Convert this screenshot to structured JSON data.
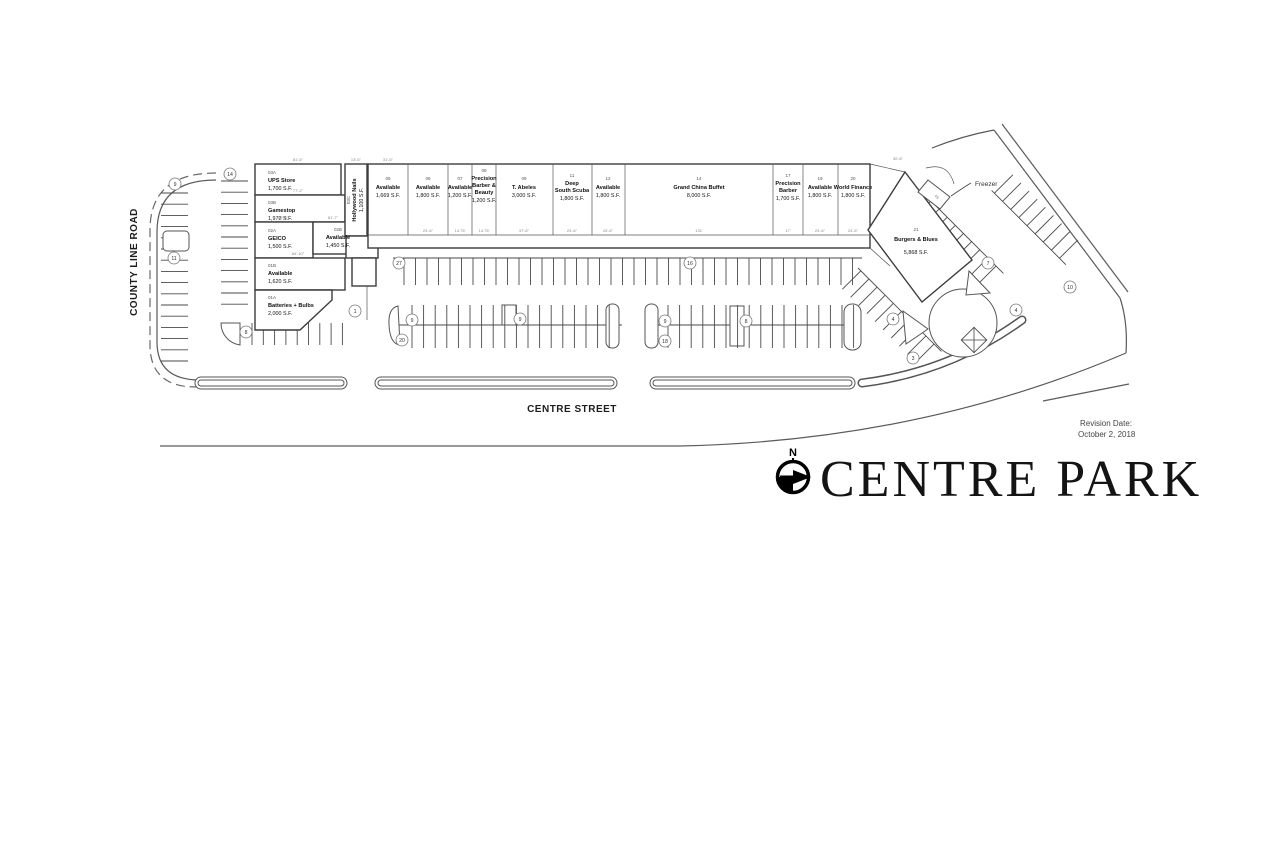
{
  "plan": {
    "title": "CENTRE PARK",
    "north": "N",
    "revision_label": "Revision Date:",
    "revision_date": "October 2, 2018",
    "street_west": "COUNTY LINE ROAD",
    "street_south": "CENTRE STREET",
    "freezer": "Freezer"
  },
  "west_building": {
    "units": [
      {
        "num": "03A",
        "name": "UPS Store",
        "sqft": "1,700 S.F."
      },
      {
        "num": "03B",
        "name": "Gamestop",
        "sqft": "1,972 S.F."
      },
      {
        "num": "02A",
        "name": "GEICO",
        "sqft": "1,500 S.F."
      },
      {
        "num": "02B",
        "name": "Available",
        "sqft": "1,450 S.F."
      },
      {
        "num": "01B",
        "name": "Available",
        "sqft": "1,620 S.F."
      },
      {
        "num": "01A",
        "name": "Batteries + Bulbs",
        "sqft": "2,000 S.F."
      },
      {
        "num": "03C",
        "name": "Hollywood Nails",
        "sqft": "1,100 S.F."
      }
    ]
  },
  "strip_building": {
    "units": [
      {
        "num": "05",
        "n1": "Available",
        "sqft": "1,669 S.F."
      },
      {
        "num": "06",
        "n1": "Available",
        "sqft": "1,800 S.F."
      },
      {
        "num": "07",
        "n1": "Available",
        "sqft": "1,200 S.F."
      },
      {
        "num": "08",
        "n1": "Precision",
        "n2": "Barber &",
        "n3": "Beauty",
        "sqft": "1,200 S.F."
      },
      {
        "num": "09",
        "n1": "T. Abeles",
        "sqft": "3,000 S.F."
      },
      {
        "num": "11",
        "n1": "Deep",
        "n2": "South Scuba",
        "sqft": "1,800 S.F."
      },
      {
        "num": "12",
        "n1": "Available",
        "sqft": "1,800 S.F."
      },
      {
        "num": "14",
        "n1": "Grand China Buffet",
        "sqft": "8,000 S.F."
      },
      {
        "num": "17",
        "n1": "Precision",
        "n2": "Barber",
        "sqft": "1,700 S.F."
      },
      {
        "num": "19",
        "n1": "Available",
        "sqft": "1,800 S.F."
      },
      {
        "num": "20",
        "n1": "World Finance",
        "sqft": "1,800 S.F."
      }
    ]
  },
  "pad": {
    "num": "21",
    "name": "Burgers & Blues",
    "sqft": "5,868 S.F."
  },
  "parking_badges": [
    "9",
    "11",
    "14",
    "8",
    "1",
    "27",
    "16",
    "9",
    "20",
    "9",
    "9",
    "18",
    "8",
    "4",
    "3",
    "7",
    "4",
    "10"
  ],
  "dims": [
    "81'-6\"",
    "77'-2\"",
    "60'-6\"",
    "81'-7\"",
    "84'-10\"",
    "13'-6\"",
    "31'-6\"",
    "24'-6\"",
    "14.75'",
    "14.75'",
    "37'-6\"",
    "24'-6\"",
    "24'-6\"",
    "131'",
    "17'",
    "24'-6\"",
    "24'-6\"",
    "30'-6\"",
    "45'"
  ]
}
